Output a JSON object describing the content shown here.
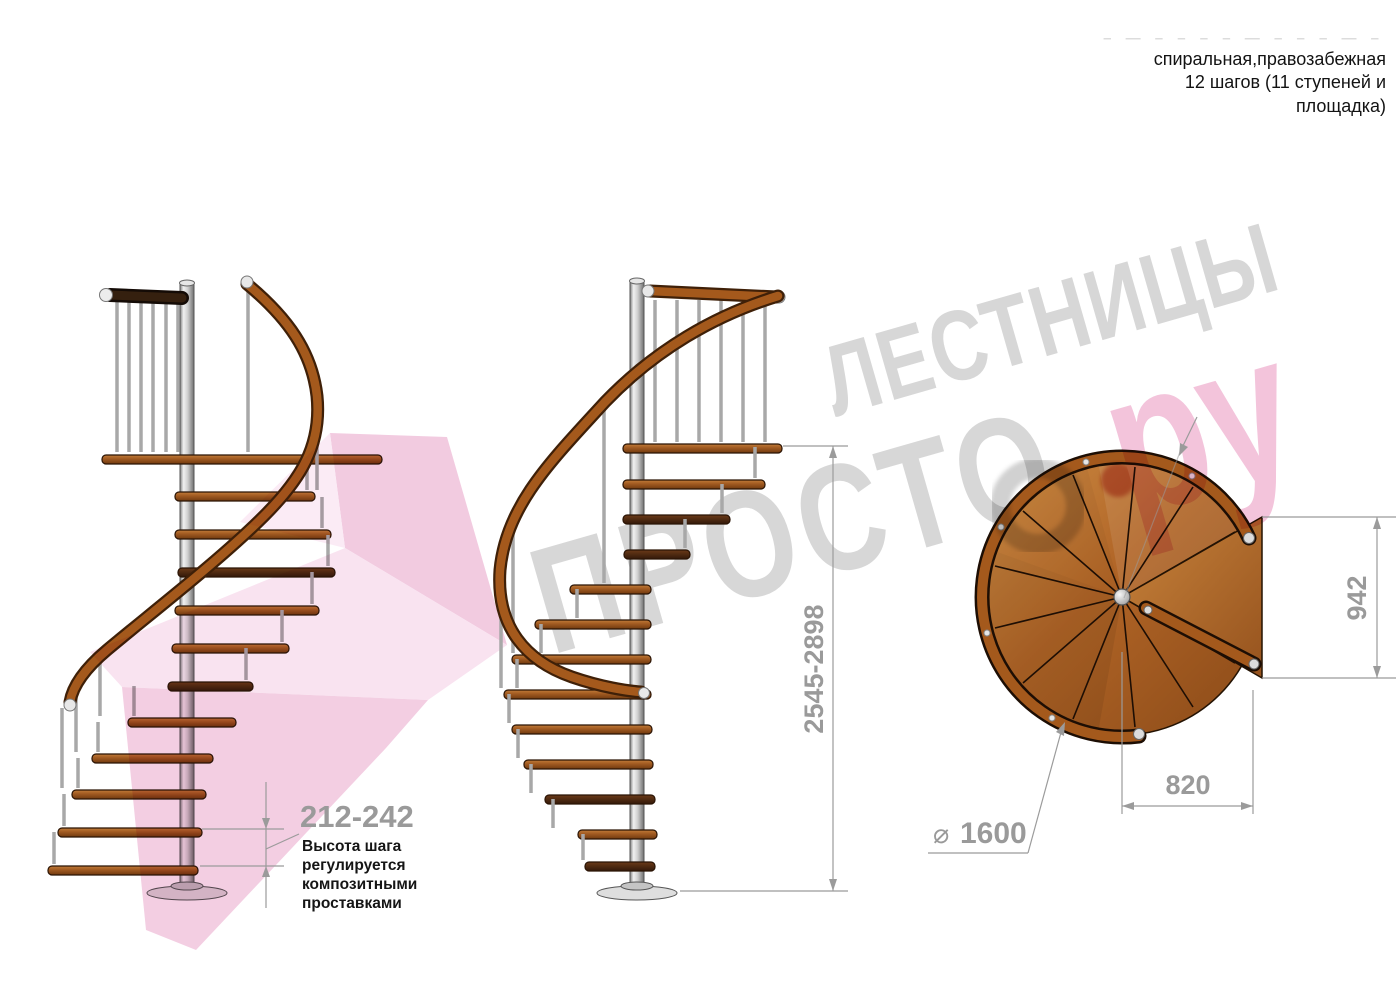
{
  "page": {
    "width": 1400,
    "height": 1000,
    "background": "#ffffff"
  },
  "header": {
    "faded_marks": "– — – – – – — – – – — –",
    "description_lines": [
      "спиральная,правозабежная",
      "12 шагов (11 ступеней и",
      "площадка)"
    ]
  },
  "watermark": {
    "brand_line1": "ЛЕСТНИЦЫ",
    "brand_line2": "ПРОСТО",
    "brand_suffix": "ру",
    "gray": "#d7d7d7",
    "pink": "#f2bed8",
    "dot_red": "#c94b3c",
    "ribbon_pink": "#f3cce1"
  },
  "dimensions": {
    "step_height": {
      "value": "212-242",
      "note_lines": [
        "Высота шага",
        "регулируется",
        "композитными",
        "проставками"
      ]
    },
    "total_height": {
      "value": "2545-2898"
    },
    "landing_depth": {
      "value": "942"
    },
    "plan_width": {
      "value": "820"
    },
    "diameter": {
      "symbol": "⌀",
      "value": "1600"
    }
  },
  "colors": {
    "wood": "#a4591c",
    "wood_dark": "#4a2a16",
    "metal": "#c9c9c9",
    "dimension_gray": "#9a9a9a",
    "note_black": "#151515"
  }
}
